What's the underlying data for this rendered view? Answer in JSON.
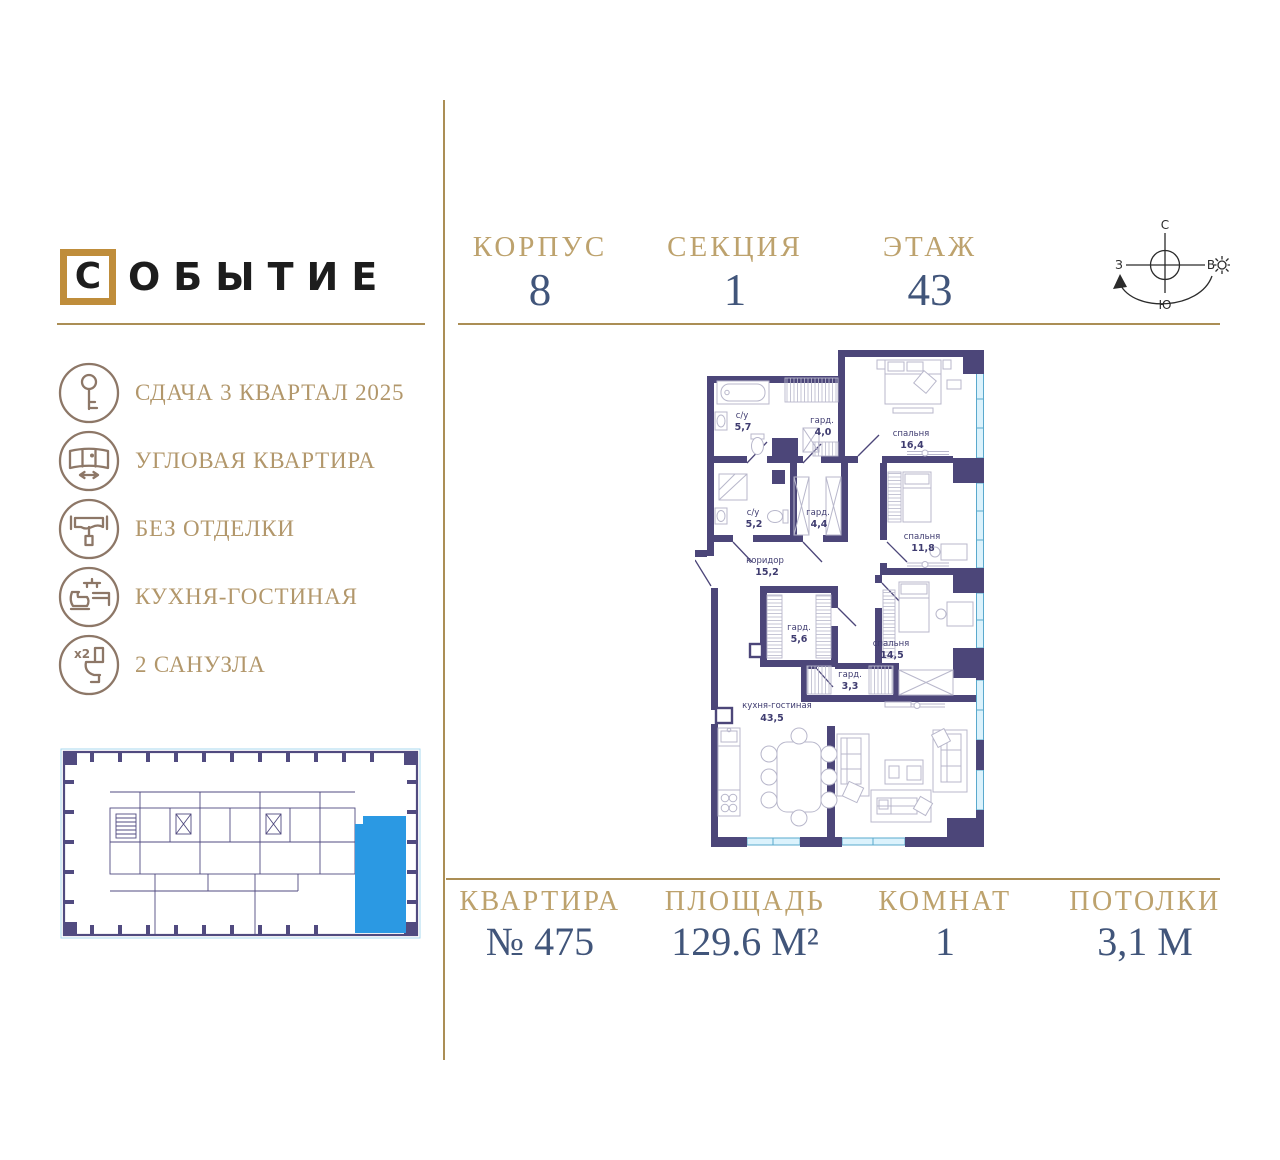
{
  "brand": {
    "logo_boxed_letter": "С",
    "logo_rest": "ОБЫТИЕ"
  },
  "sidebar": {
    "features": [
      {
        "icon": "key-icon",
        "label": "СДАЧА 3 КВАРТАЛ 2025"
      },
      {
        "icon": "corner-window-icon",
        "label": "УГЛОВАЯ КВАРТИРА"
      },
      {
        "icon": "paint-roller-icon",
        "label": "БЕЗ ОТДЕЛКИ"
      },
      {
        "icon": "kitchen-living-icon",
        "label": "КУХНЯ-ГОСТИНАЯ"
      },
      {
        "icon": "toilet-x2-icon",
        "label": "2 САНУЗЛА",
        "badge": "x2"
      }
    ]
  },
  "header": {
    "fields": [
      {
        "label": "КОРПУС",
        "value": "8"
      },
      {
        "label": "СЕКЦИЯ",
        "value": "1"
      },
      {
        "label": "ЭТАЖ",
        "value": "43"
      }
    ]
  },
  "compass": {
    "north": "С",
    "south": "Ю",
    "west": "З",
    "east": "В"
  },
  "floor_plan": {
    "rooms": [
      {
        "name": "с/у",
        "area": "5,7"
      },
      {
        "name": "гард.",
        "area": "4,0"
      },
      {
        "name": "спальня",
        "area": "16,4"
      },
      {
        "name": "с/у",
        "area": "5,2"
      },
      {
        "name": "гард.",
        "area": "4,4"
      },
      {
        "name": "спальня",
        "area": "11,8"
      },
      {
        "name": "коридор",
        "area": "15,2"
      },
      {
        "name": "гард.",
        "area": "5,6"
      },
      {
        "name": "спальня",
        "area": "14,5"
      },
      {
        "name": "гард.",
        "area": "3,3"
      },
      {
        "name": "кухня-гостиная",
        "area": "43,5"
      }
    ]
  },
  "footer": {
    "fields": [
      {
        "label": "КВАРТИРА",
        "value": "№ 475"
      },
      {
        "label": "ПЛОЩАДЬ",
        "value": "129.6 М²"
      },
      {
        "label": "КОМНАТ",
        "value": "1"
      },
      {
        "label": "ПОТОЛКИ",
        "value": "3,1 М"
      }
    ]
  },
  "colors": {
    "gold_label": "#bda26d",
    "navy_value": "#41557a",
    "sidebar_text": "#b2976b",
    "icon_brown": "#8d7767",
    "divider_gold": "#ab8e55",
    "wall_purple": "#4c4679",
    "logo_frame_gold": "#bf8d3b",
    "highlighted_unit_blue": "#2b99e3",
    "window_glass": "#dbf2fc"
  }
}
